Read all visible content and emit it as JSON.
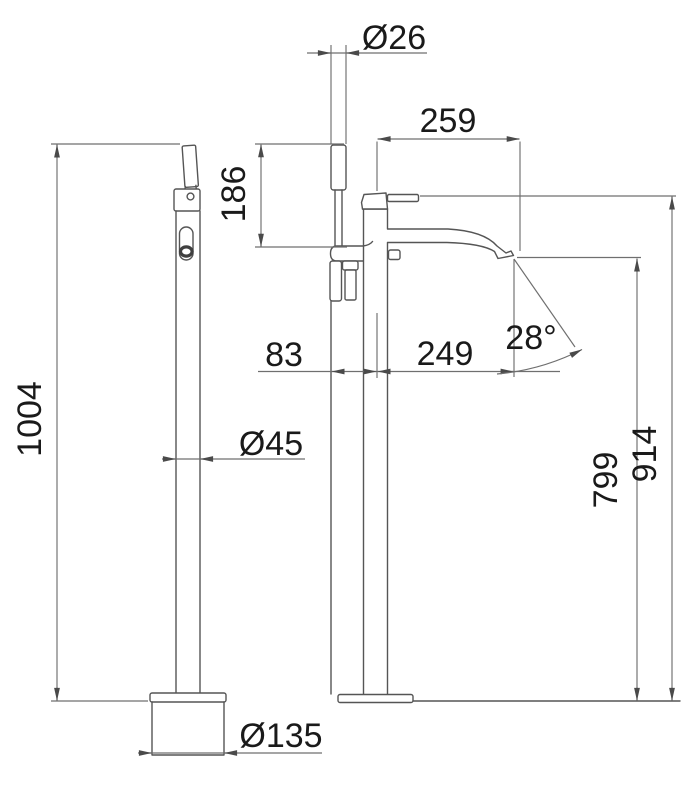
{
  "page": {
    "background": "#ffffff"
  },
  "drawing": {
    "type": "technical-dimension-drawing",
    "subject": "Freestanding bath mixer column with hand shower — front view and side view",
    "views": [
      "front-view-column",
      "side-view-mixer"
    ],
    "colors": {
      "product_line": "#555555",
      "dimension_line": "#6f6f6f",
      "text": "#1a1a1a",
      "background": "#ffffff"
    },
    "dimensions": {
      "hand_shower_diameter": "Ø26",
      "spout_total_reach": "259",
      "hand_shower_exposed_height": "186",
      "hand_shower_offset": "83",
      "spout_reach": "249",
      "spout_angle": "28°",
      "spout_outlet_height": "799",
      "mixer_top_height": "914",
      "total_height": "1004",
      "column_diameter": "Ø45",
      "base_diameter": "Ø135"
    }
  }
}
